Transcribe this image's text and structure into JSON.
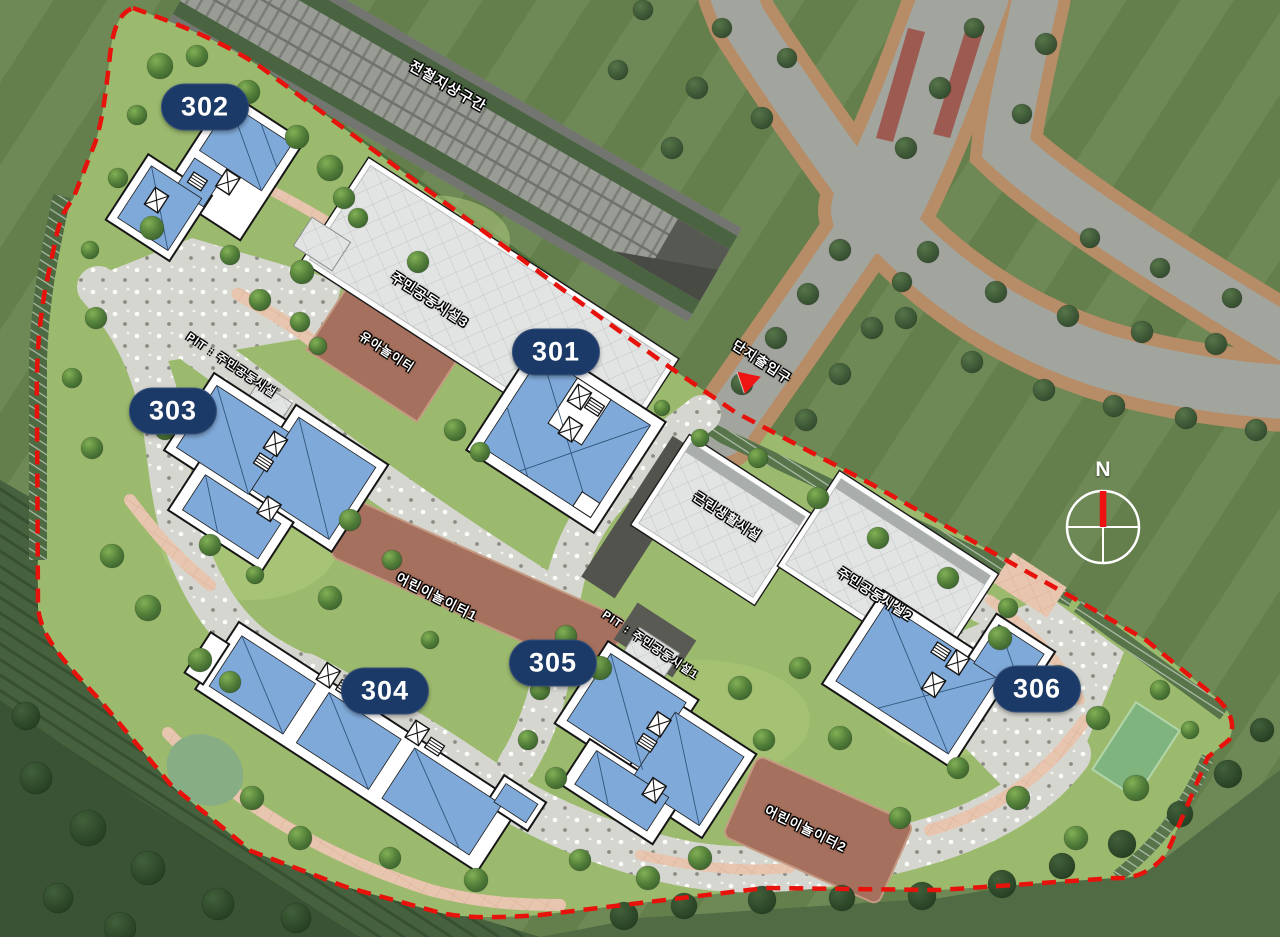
{
  "buildings": [
    {
      "label": "301"
    },
    {
      "label": "302"
    },
    {
      "label": "303"
    },
    {
      "label": "304"
    },
    {
      "label": "305"
    },
    {
      "label": "306"
    }
  ],
  "labels": {
    "railway": "전철지상구간",
    "community_facility_3": "주민공동시설3",
    "toddler_playground": "유아놀이터",
    "complex_entrance": "단지출입구",
    "pit_community_facility": "PIT : 주민공동시설",
    "neighborhood_facility": "근린생활시설",
    "community_facility_2": "주민공동시설2",
    "pit_community_facility_1": "PIT : 주민공동시설1",
    "children_playground_1": "어린이놀이터1",
    "children_playground_2": "어린이놀이터2"
  },
  "compass": {
    "north_label": "N"
  },
  "colors": {
    "site_boundary": "#e8120c",
    "badge_background": "#1c3a67",
    "apartment_roof": "#7fa9d8",
    "facility_roof": "#e2e4e3",
    "playground_surface": "#a5705d",
    "inner_grass": "#9cba6e",
    "outer_grass": "#68834f",
    "asphalt_road": "#a2a49e",
    "walkway_gray": "#d6d6d1",
    "walkway_pink": "#e8c5ae",
    "entrance_marker": "#ee1414",
    "compass_needle": "#ee1111"
  }
}
